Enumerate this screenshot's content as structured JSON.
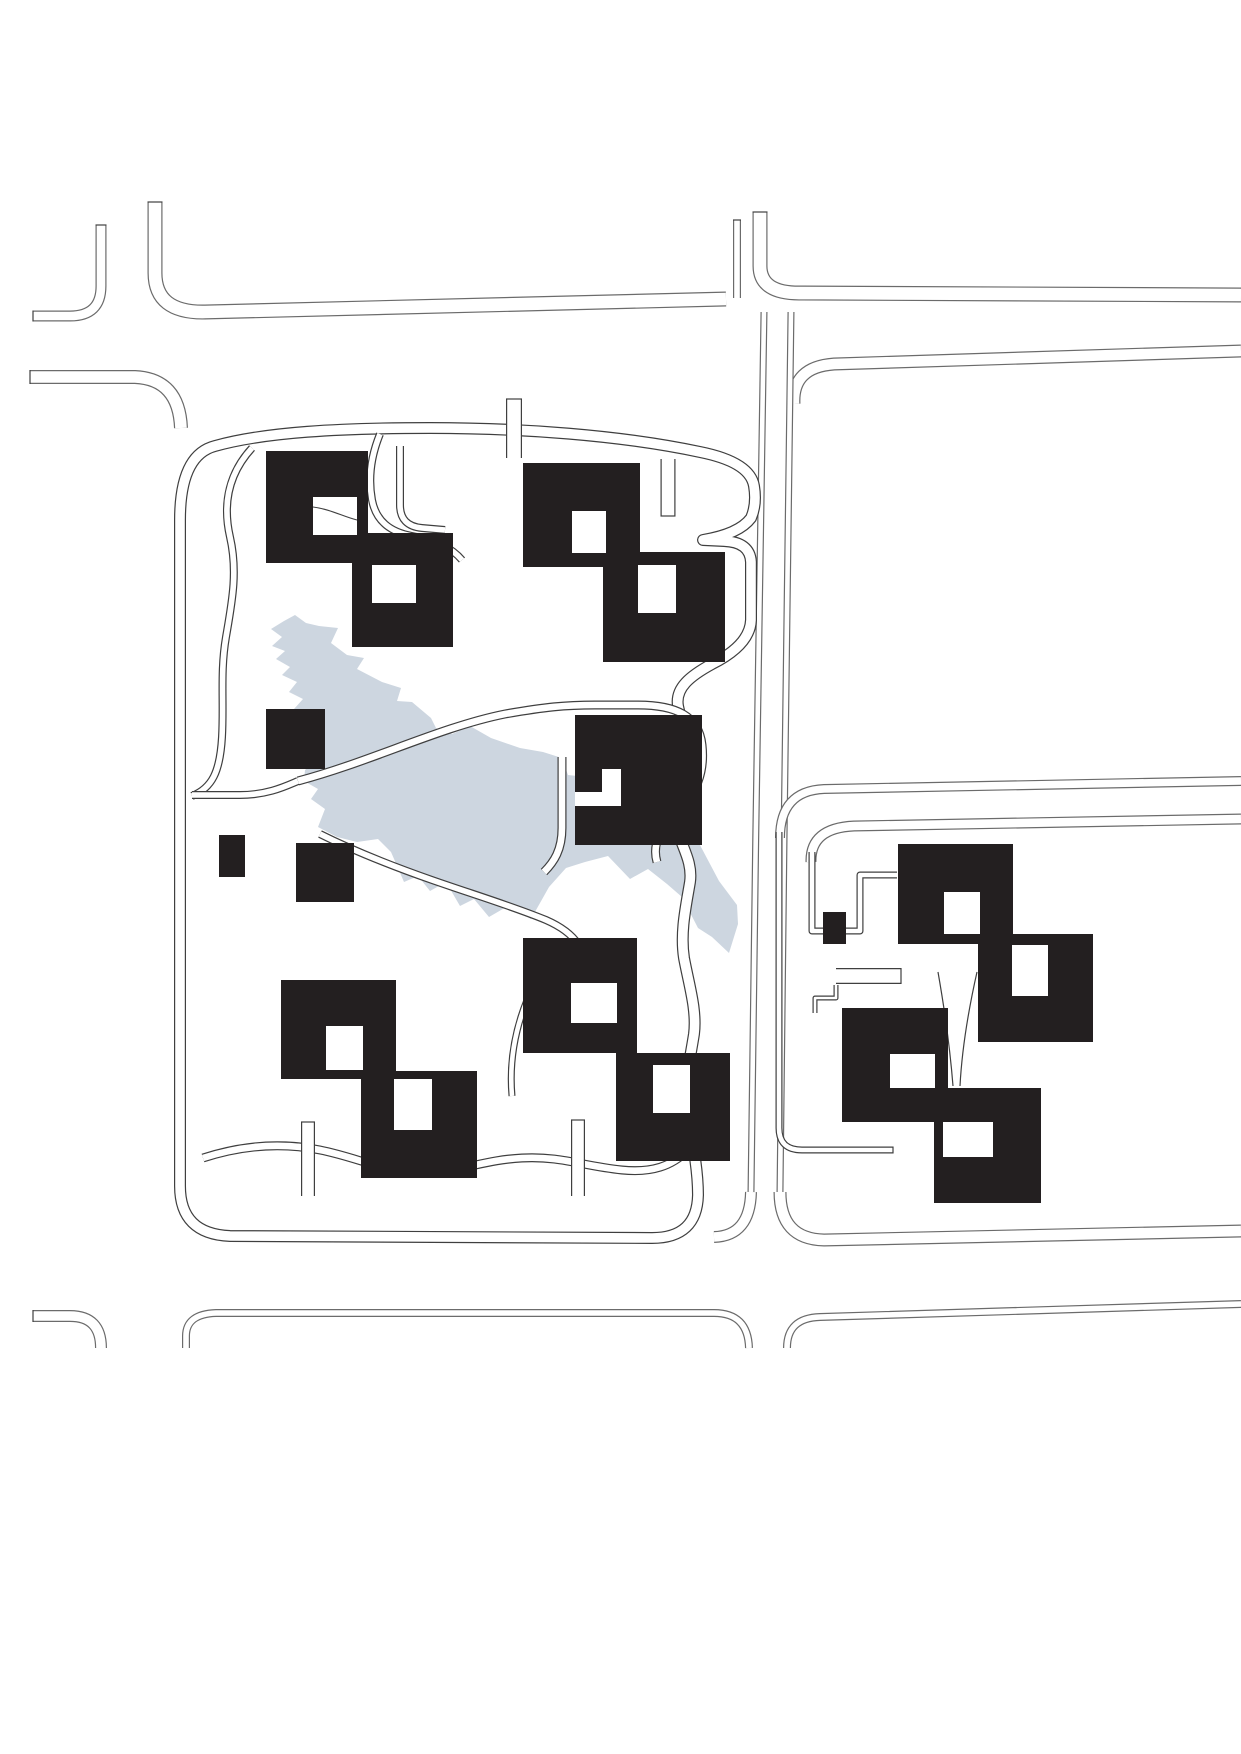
{
  "meta": {
    "kind": "architectural-site-plan",
    "canvas_w": 1241,
    "canvas_h": 1754
  },
  "colors": {
    "background": "#ffffff",
    "building": "#231f20",
    "hole": "#ffffff",
    "water": "#cdd6e0",
    "street_line": "#6b6b6b",
    "path_line": "#3f3f3f",
    "street_fill": "#ffffff"
  },
  "lake": {
    "d": "M295,615 L306,623 L319,626 L338,628 L331,643 L347,655 L364,658 L357,669 L382,682 L401,688 L397,701 L412,702 L431,718 L436,728 L452,734 L470,726 L491,738 L520,748 L543,752 L562,758 L568,775 L596,778 L612,793 L629,788 L645,805 L661,801 L674,817 L683,813 L701,847 L719,881 L737,905 L738,924 L729,953 L712,937 L698,928 L682,897 L667,884 L648,869 L630,879 L608,856 L585,862 L566,868 L549,887 L531,919 L508,906 L489,917 L474,899 L460,906 L446,882 L430,891 L418,876 L404,882 L391,852 L378,839 L357,842 L337,837 L318,827 L325,809 L311,799 L318,789 L304,781 L305,770 L314,762 L302,751 L312,739 L299,731 L308,719 L294,709 L303,699 L289,692 L297,682 L282,675 L290,667 L276,659 L285,651 L272,646 L282,637 L271,629 L284,621 Z"
  },
  "streets": [
    {
      "name": "street-nw-corner-strip",
      "d": "M101,225 L101,286 Q101,316 70,316 L33,316",
      "w": 11
    },
    {
      "name": "street-top-north-left",
      "d": "M155,202 L155,273 Q155,313 205,312 L726,299",
      "w": 15
    },
    {
      "name": "street-top-stub-left",
      "d": "M737,220 L737,298",
      "w": 8
    },
    {
      "name": "street-top-north-right",
      "d": "M760,212 L760,266 Q760,294 802,293 L1241,295",
      "w": 15
    },
    {
      "name": "street-second-south-west",
      "d": "M30,377 L135,377 Q179,379 181,428",
      "w": 14
    },
    {
      "name": "street-second-south-right",
      "d": "M794,404 Q792,367 834,364 L1241,351",
      "w": 13
    },
    {
      "name": "street-mid-vertical-left",
      "d": "M764,312 C760,600 754,900 751,1192",
      "w": 7
    },
    {
      "name": "street-mid-vertical-left-foot",
      "d": "M751,1192 Q750,1236 714,1237",
      "w": 12
    },
    {
      "name": "street-mid-vertical-right",
      "d": "M791,312 C787,600 783,900 780,1192",
      "w": 7
    },
    {
      "name": "street-bottom-north-right",
      "d": "M780,1192 Q780,1239 824,1240 L1241,1231",
      "w": 13
    },
    {
      "name": "street-east-mid-north",
      "d": "M780,838 Q780,791 824,789 L1241,781",
      "w": 10
    },
    {
      "name": "street-east-mid-south",
      "d": "M811,862 Q810,828 854,826 L1241,819",
      "w": 11
    },
    {
      "name": "street-sw-corner-strip",
      "d": "M33,1316 L70,1316 Q101,1316 101,1348",
      "w": 12
    },
    {
      "name": "street-bottom-block-left",
      "d": "M186,1348 L186,1336 Q186,1314 216,1313 L714,1313 Q748,1313 749,1348",
      "w": 8
    },
    {
      "name": "street-bottom-block-right",
      "d": "M787,1348 Q787,1318 820,1317 L1241,1304",
      "w": 8
    }
  ],
  "site_paths": [
    {
      "name": "left-block-boundary-ring",
      "w": 12,
      "d": "M180,520 L180,1186 Q180,1234 230,1236 L652,1238 Q697,1238 698,1195 C698,1168 692,1140 687,1112 C683,1088 690,1060 694,1034 C697,1010 689,985 684,958 C680,932 686,906 690,882 C693,860 680,845 676,824 C672,800 695,792 694,766 C693,740 682,728 678,706 C675,688 690,676 712,664 Q750,645 751,620 L751,562 Q750,542 724,541 L703,540 Q739,534 751,518 Q757,504 754,486 Q750,462 700,452 C620,435 520,428 430,428 C340,428 265,432 215,446 Q180,455 180,520 Z"
    },
    {
      "name": "path-west-scurve",
      "d": "M252,448 C230,472 222,502 230,537 C238,572 232,602 226,637 C220,672 224,702 222,737 C220,772 212,788 192,796",
      "w": 8
    },
    {
      "name": "path-cluster1-east-loop",
      "d": "M380,434 C371,456 368,478 372,500 C376,521 390,532 412,536 C436,540 452,548 462,560",
      "w": 8
    },
    {
      "name": "path-north-drop",
      "d": "M400,446 L400,505 Q400,526 422,528 L445,530",
      "w": 8
    },
    {
      "name": "path-north-stub",
      "d": "M514,399 L514,458",
      "w": 16
    },
    {
      "name": "path-south-stub-ne",
      "d": "M668,459 L668,516",
      "w": 15
    },
    {
      "name": "path-lake-crossing",
      "d": "M298,781 C370,762 440,727 505,714 C545,707 565,705 595,705 L638,705 C676,705 699,716 702,745 C705,772 697,793 676,813 C660,828 652,845 657,862",
      "w": 9
    },
    {
      "name": "path-west-shore",
      "d": "M192,795 L240,795 C268,795 286,786 298,781",
      "w": 8
    },
    {
      "name": "path-central-square-west",
      "d": "M562,757 L562,828 C562,850 554,862 544,872",
      "w": 9
    },
    {
      "name": "path-south-shore",
      "d": "M320,834 C356,852 392,866 432,880 C472,894 512,906 546,920 C562,927 572,935 578,944",
      "w": 8
    },
    {
      "name": "path-mid-drop",
      "d": "M527,1000 C515,1030 509,1062 512,1096",
      "w": 7
    },
    {
      "name": "path-bottom-wavy",
      "d": "M203,1158 C240,1146 280,1142 320,1150 C360,1158 382,1172 422,1172 C462,1172 482,1160 522,1158 C562,1156 582,1166 622,1170 C652,1173 672,1166 688,1150",
      "w": 9
    },
    {
      "name": "path-bottom-stub-1",
      "d": "M308,1122 L308,1196",
      "w": 14
    },
    {
      "name": "path-bottom-stub-2",
      "d": "M578,1120 L578,1196",
      "w": 14
    },
    {
      "name": "path-right-block-west-L",
      "d": "M779,832 C779,870 779,920 779,970 L779,1128 Q779,1150 802,1150 L893,1150",
      "w": 7
    },
    {
      "name": "path-right-block-steps",
      "d": "M812,852 L812,931 L860,931 L860,875 L897,875",
      "w": 7
    },
    {
      "name": "path-right-block-bar",
      "d": "M836,976 L901,976",
      "w": 16
    },
    {
      "name": "path-right-block-conn",
      "d": "M836,985 L836,998 L815,998 L815,1013",
      "w": 5
    }
  ],
  "cap_lines": [
    {
      "name": "cap-nw-strip-top",
      "x1": 95.5,
      "y1": 225,
      "x2": 106.5,
      "y2": 225
    },
    {
      "name": "cap-nw-strip-end",
      "x1": 33,
      "y1": 310.5,
      "x2": 33,
      "y2": 321.5
    },
    {
      "name": "cap-top-stub-left",
      "x1": 147.5,
      "y1": 202,
      "x2": 162.5,
      "y2": 202
    },
    {
      "name": "cap-top-stub-mid",
      "x1": 733,
      "y1": 220,
      "x2": 741,
      "y2": 220
    },
    {
      "name": "cap-top-stub-right",
      "x1": 752.5,
      "y1": 212,
      "x2": 767.5,
      "y2": 212
    },
    {
      "name": "cap-second-street-w",
      "x1": 30,
      "y1": 370,
      "x2": 30,
      "y2": 384
    },
    {
      "name": "cap-sw-strip-end",
      "x1": 33,
      "y1": 1310,
      "x2": 33,
      "y2": 1322
    },
    {
      "name": "cap-north-stub",
      "x1": 506,
      "y1": 399,
      "x2": 522,
      "y2": 399
    },
    {
      "name": "cap-ne-stub",
      "x1": 660.5,
      "y1": 516,
      "x2": 675.5,
      "y2": 516
    },
    {
      "name": "cap-bottom-stub-1",
      "x1": 301,
      "y1": 1122,
      "x2": 315,
      "y2": 1122
    },
    {
      "name": "cap-bottom-stub-2",
      "x1": 571,
      "y1": 1120,
      "x2": 585,
      "y2": 1120
    },
    {
      "name": "cap-right-L-end",
      "x1": 893,
      "y1": 1146.5,
      "x2": 893,
      "y2": 1153.5
    },
    {
      "name": "cap-right-bar-end",
      "x1": 901,
      "y1": 968,
      "x2": 901,
      "y2": 984
    }
  ],
  "buildings": [
    {
      "name": "cluster1-square-a",
      "x": 266,
      "y": 451,
      "w": 102,
      "h": 112
    },
    {
      "name": "cluster1-square-b",
      "x": 352,
      "y": 533,
      "w": 101,
      "h": 114
    },
    {
      "name": "cluster2-square-a",
      "x": 523,
      "y": 463,
      "w": 117,
      "h": 104
    },
    {
      "name": "cluster2-square-b",
      "x": 603,
      "y": 552,
      "w": 122,
      "h": 110
    },
    {
      "name": "central-notched-square",
      "x": 575,
      "y": 715,
      "w": 127,
      "h": 130
    },
    {
      "name": "cluster4-square-a",
      "x": 281,
      "y": 980,
      "w": 115,
      "h": 99
    },
    {
      "name": "cluster4-square-b",
      "x": 361,
      "y": 1071,
      "w": 116,
      "h": 107
    },
    {
      "name": "cluster5-square-a",
      "x": 523,
      "y": 938,
      "w": 114,
      "h": 115
    },
    {
      "name": "cluster5-square-b",
      "x": 616,
      "y": 1053,
      "w": 114,
      "h": 108
    },
    {
      "name": "cluster6-square-a",
      "x": 898,
      "y": 844,
      "w": 115,
      "h": 100
    },
    {
      "name": "cluster6-square-b",
      "x": 978,
      "y": 934,
      "w": 115,
      "h": 108
    },
    {
      "name": "cluster7-square-a",
      "x": 842,
      "y": 1008,
      "w": 106,
      "h": 114
    },
    {
      "name": "cluster7-square-b",
      "x": 934,
      "y": 1088,
      "w": 107,
      "h": 115
    },
    {
      "name": "small-square-west",
      "x": 266,
      "y": 709,
      "w": 59,
      "h": 60
    },
    {
      "name": "small-rect-west",
      "x": 219,
      "y": 835,
      "w": 26,
      "h": 42
    },
    {
      "name": "small-square-southwest",
      "x": 296,
      "y": 843,
      "w": 58,
      "h": 59
    },
    {
      "name": "small-square-east",
      "x": 823,
      "y": 912,
      "w": 23,
      "h": 32
    }
  ],
  "holes": [
    {
      "name": "cluster1-a-court",
      "x": 313,
      "y": 497,
      "w": 44,
      "h": 38
    },
    {
      "name": "cluster1-b-court",
      "x": 372,
      "y": 565,
      "w": 44,
      "h": 38
    },
    {
      "name": "cluster2-a-court",
      "x": 572,
      "y": 511,
      "w": 34,
      "h": 42
    },
    {
      "name": "cluster2-b-court",
      "x": 638,
      "y": 565,
      "w": 38,
      "h": 48
    },
    {
      "name": "central-notch-horizontal",
      "x": 575,
      "y": 792,
      "w": 46,
      "h": 14
    },
    {
      "name": "central-notch-vertical",
      "x": 602,
      "y": 769,
      "w": 19,
      "h": 37
    },
    {
      "name": "cluster4-a-court",
      "x": 326,
      "y": 1026,
      "w": 37,
      "h": 44
    },
    {
      "name": "cluster4-b-court",
      "x": 394,
      "y": 1079,
      "w": 38,
      "h": 51
    },
    {
      "name": "cluster5-a-court",
      "x": 571,
      "y": 983,
      "w": 46,
      "h": 40
    },
    {
      "name": "cluster5-b-court",
      "x": 653,
      "y": 1065,
      "w": 37,
      "h": 48
    },
    {
      "name": "cluster6-a-court",
      "x": 944,
      "y": 892,
      "w": 36,
      "h": 42
    },
    {
      "name": "cluster6-b-court",
      "x": 1012,
      "y": 945,
      "w": 36,
      "h": 51
    },
    {
      "name": "cluster7-a-court",
      "x": 890,
      "y": 1054,
      "w": 45,
      "h": 34
    },
    {
      "name": "cluster7-b-court",
      "x": 943,
      "y": 1122,
      "w": 50,
      "h": 35
    }
  ],
  "detail_lines": [
    {
      "name": "wedge-line-west",
      "d": "M938,972 C945,1012 950,1048 953,1086"
    },
    {
      "name": "wedge-line-east",
      "d": "M977,972 C968,1012 962,1048 960,1086"
    }
  ],
  "overlay_lines": [
    {
      "name": "court-crossing-line",
      "d": "M313,507 C330,509 344,517 357,520"
    }
  ]
}
